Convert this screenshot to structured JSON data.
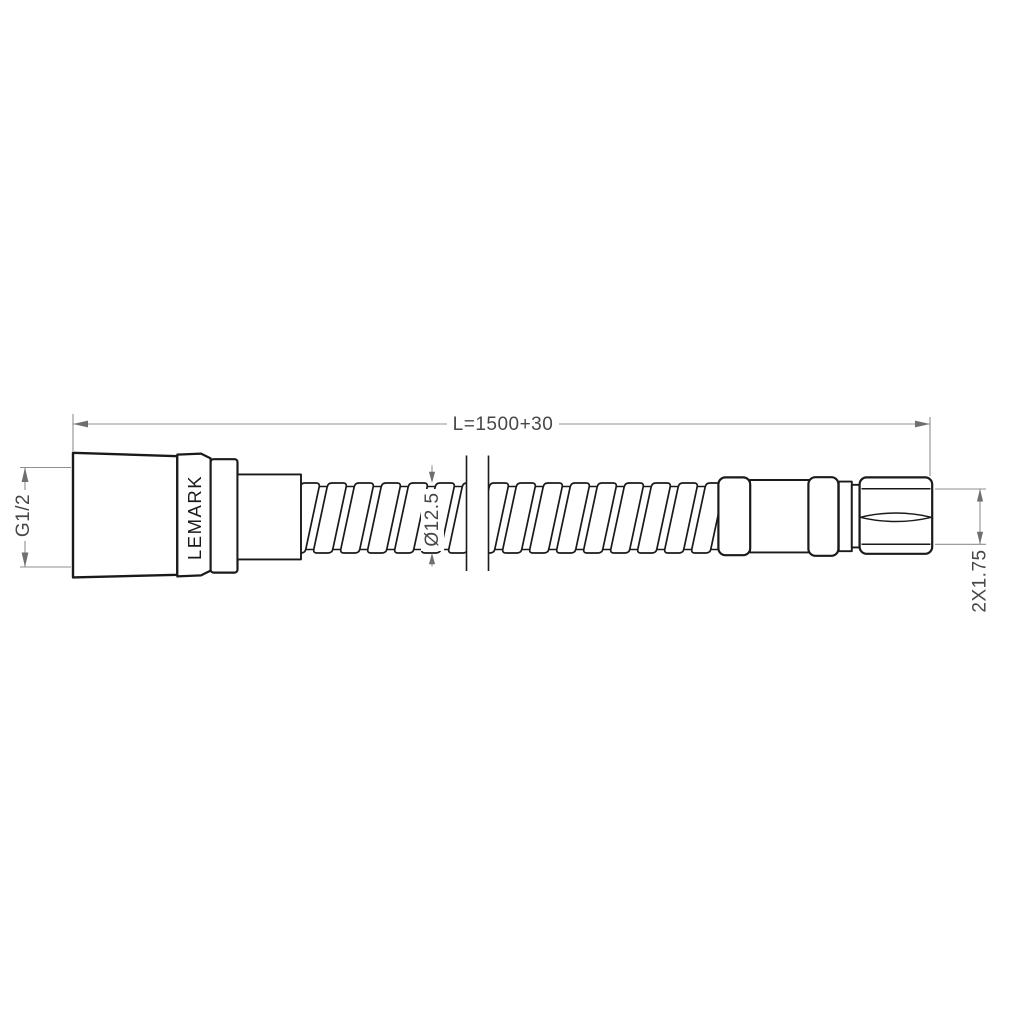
{
  "labels": {
    "length": "L=1500+30",
    "thread_left": "G1/2",
    "diameter": "Ø12.5",
    "thread_right": "2X1.75",
    "brand": "LEMARK"
  },
  "colors": {
    "background": "#ffffff",
    "outline": "#1a1a1a",
    "dimension_line": "#8f8f8f",
    "dimension_arrow": "#6f6f6f",
    "dimension_text": "#474747"
  }
}
